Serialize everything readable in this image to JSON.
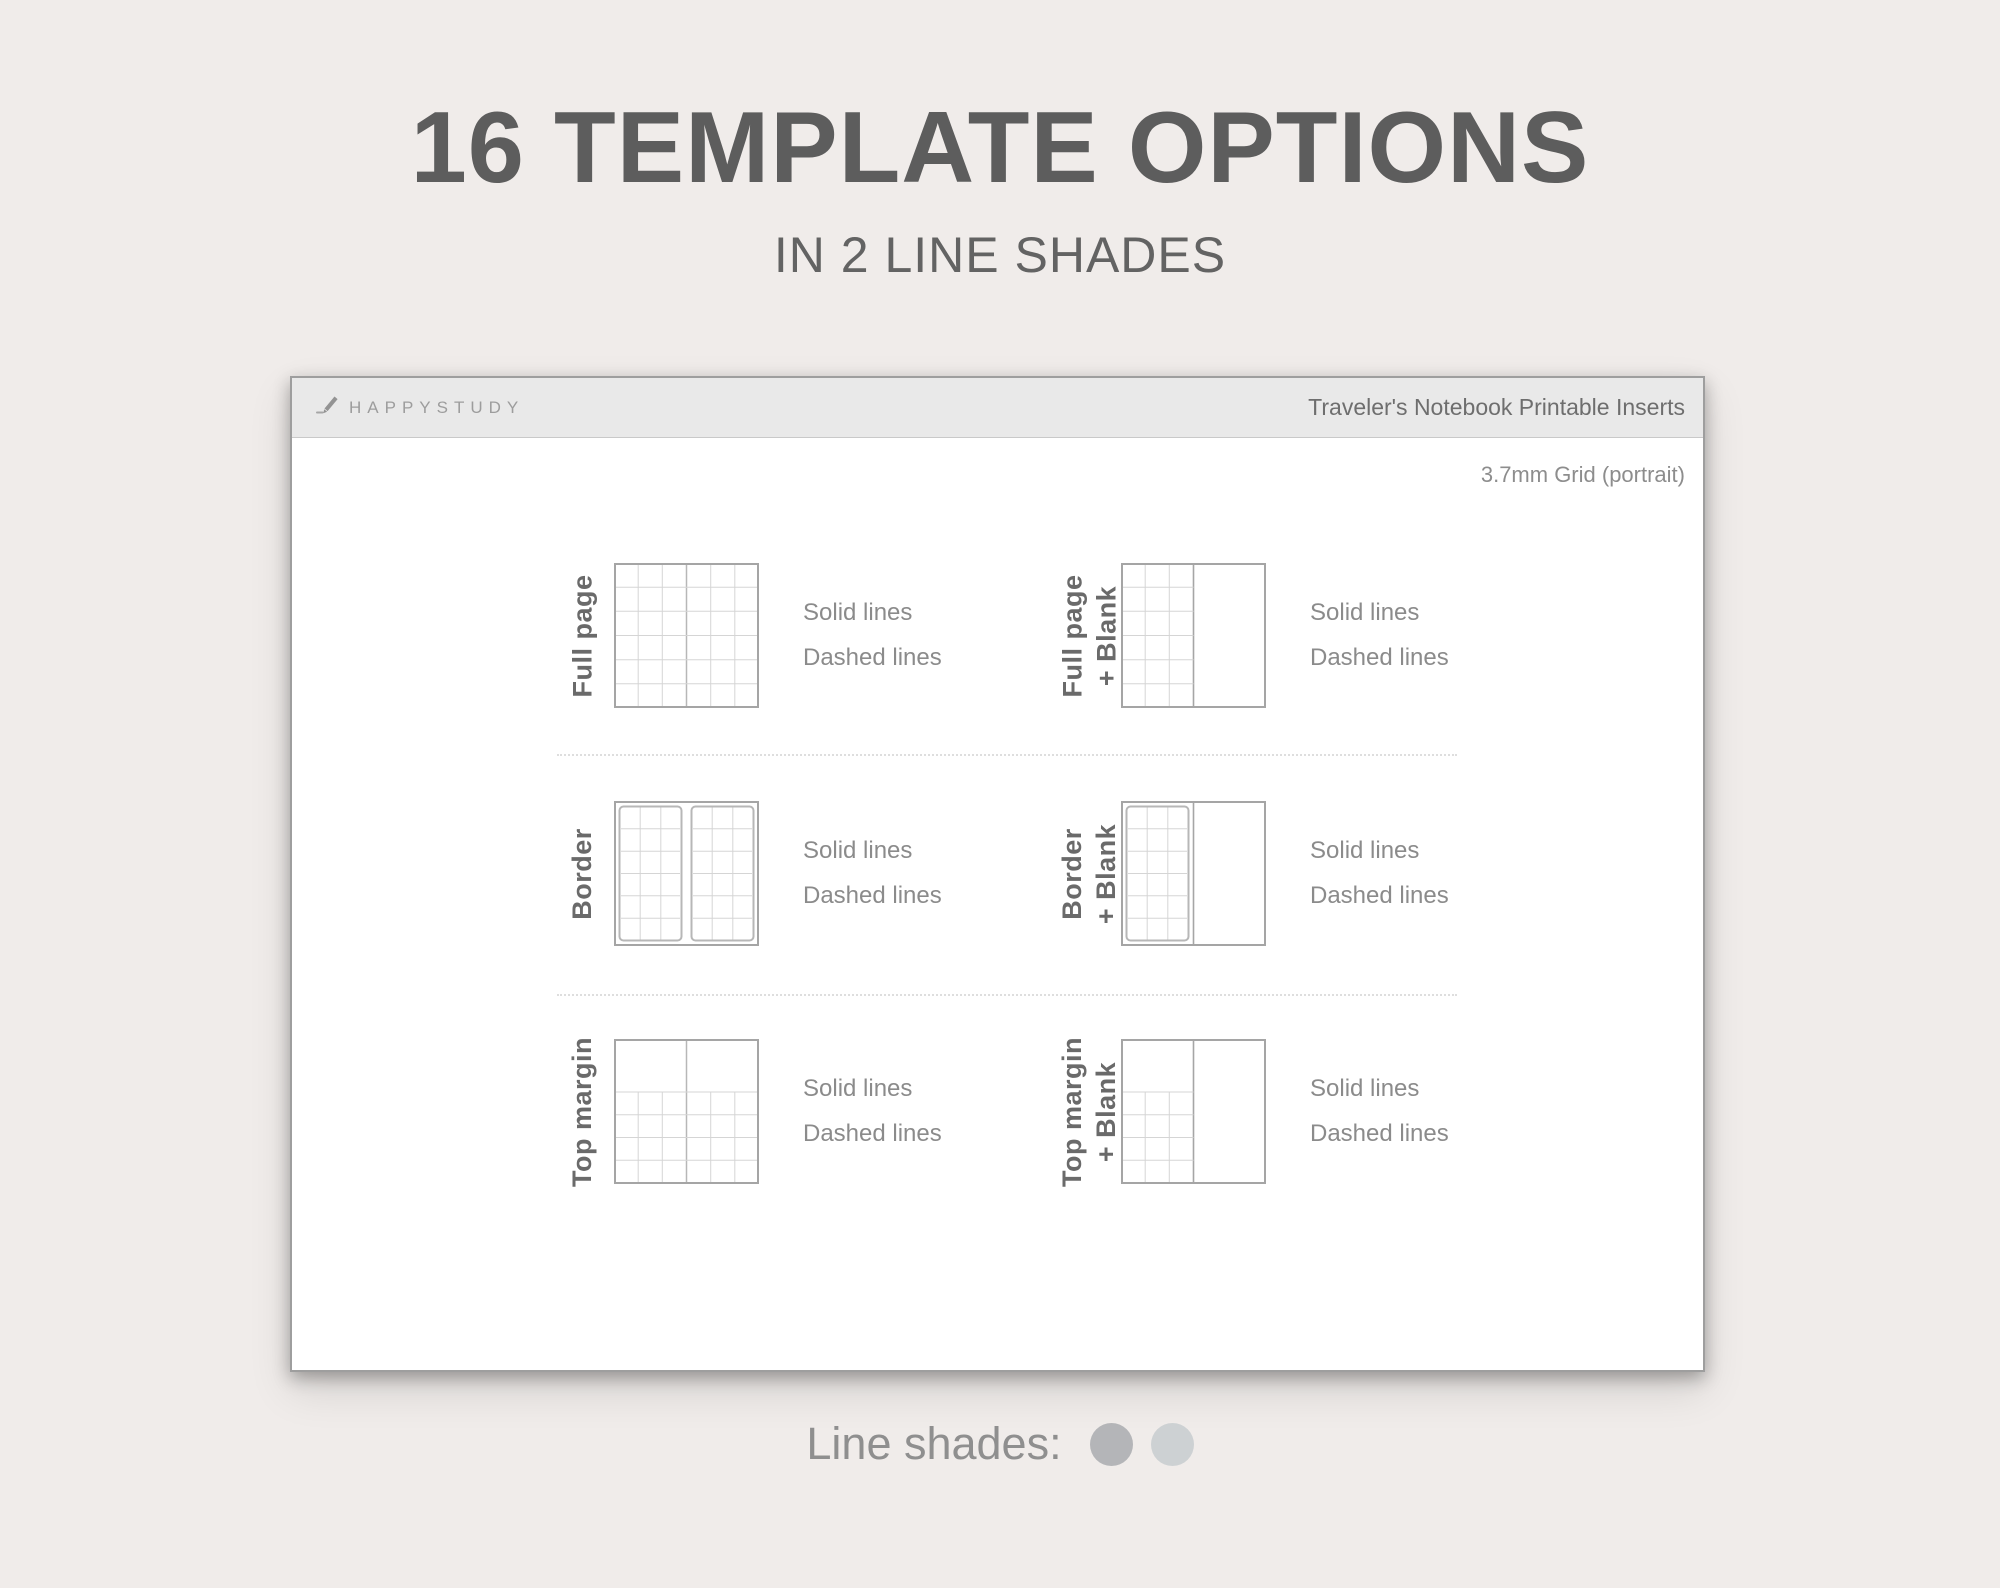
{
  "page": {
    "title": "16 TEMPLATE OPTIONS",
    "subtitle": "IN 2 LINE SHADES",
    "background_color": "#f0ecea"
  },
  "card": {
    "header": {
      "brand": "HAPPYSTUDY",
      "brand_icon": "pencil-icon",
      "title": "Traveler's Notebook Printable Inserts"
    },
    "grid_note": "3.7mm Grid (portrait)",
    "templates": [
      {
        "label": "Full page",
        "label_line2": "",
        "thumbnail": "grid-full",
        "options": [
          "Solid lines",
          "Dashed lines"
        ]
      },
      {
        "label": "Full page",
        "label_line2": "+ Blank",
        "thumbnail": "grid-left-blank",
        "options": [
          "Solid lines",
          "Dashed lines"
        ]
      },
      {
        "label": "Border",
        "label_line2": "",
        "thumbnail": "border-pages",
        "options": [
          "Solid lines",
          "Dashed lines"
        ]
      },
      {
        "label": "Border",
        "label_line2": "+ Blank",
        "thumbnail": "border-left-blank",
        "options": [
          "Solid lines",
          "Dashed lines"
        ]
      },
      {
        "label": "Top margin",
        "label_line2": "",
        "thumbnail": "top-margin",
        "options": [
          "Solid lines",
          "Dashed lines"
        ]
      },
      {
        "label": "Top margin",
        "label_line2": "+ Blank",
        "thumbnail": "top-margin-left-blank",
        "options": [
          "Solid lines",
          "Dashed lines"
        ]
      }
    ]
  },
  "footer": {
    "label": "Line shades:",
    "shades": [
      "#b4b5b8",
      "#cdd1d3"
    ]
  }
}
